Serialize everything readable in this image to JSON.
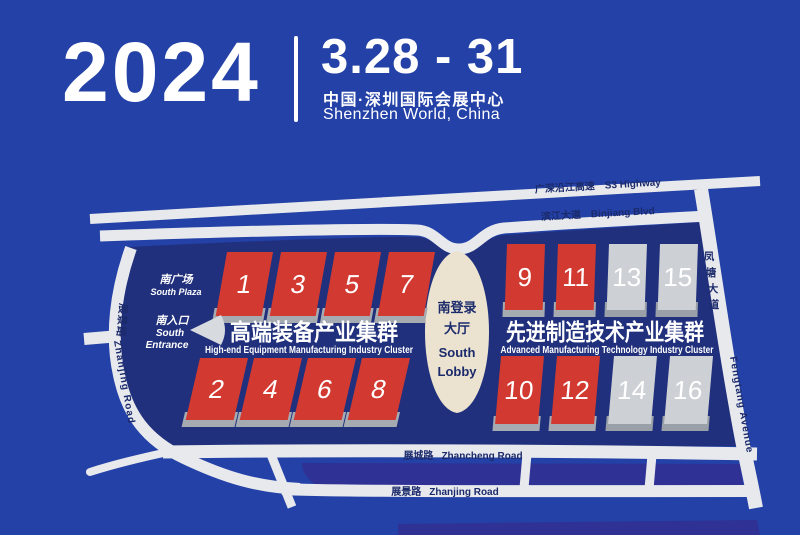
{
  "header": {
    "year": "2024",
    "dates": "3.28 - 31",
    "venue_cn": "中国·深圳国际会展中心",
    "venue_en": "Shenzhen World, China"
  },
  "map": {
    "roads": {
      "s3": {
        "cn": "广深沿江高速",
        "en": "S3 Highway"
      },
      "binjiang": {
        "cn": "滨江大道",
        "en": "Binjiang Blvd"
      },
      "fengtang": {
        "cn_chars": [
          "凤",
          "塘",
          "大",
          "道"
        ],
        "en": "Fengtang Avenue"
      },
      "zhanjing_left": {
        "cn": "展景路",
        "en": "Zhanjing Road"
      },
      "zhancheng": {
        "cn": "展城路",
        "en": "Zhancheng Road"
      },
      "zhanjing_bottom": {
        "cn": "展景路",
        "en": "Zhanjing Road"
      }
    },
    "labels": {
      "south_plaza_cn": "南广场",
      "south_plaza_en": "South Plaza",
      "south_entrance_cn": "南入口",
      "south_entrance_en1": "South",
      "south_entrance_en2": "Entrance",
      "lobby_cn1": "南登录",
      "lobby_cn2": "大厅",
      "lobby_en1": "South",
      "lobby_en2": "Lobby"
    },
    "clusters": {
      "left": {
        "title_cn": "高端装备产业集群",
        "title_en": "High-end Equipment Manufacturing Industry Cluster",
        "hall_color": "#d23a31"
      },
      "right": {
        "title_cn": "先进制造技术产业集群",
        "title_en": "Advanced Manufacturing Technology Industry Cluster",
        "hall_color": "#d23a31"
      }
    },
    "halls": [
      {
        "label": "1",
        "color": "red"
      },
      {
        "label": "3",
        "color": "red"
      },
      {
        "label": "5",
        "color": "red"
      },
      {
        "label": "7",
        "color": "red"
      },
      {
        "label": "2",
        "color": "red"
      },
      {
        "label": "4",
        "color": "red"
      },
      {
        "label": "6",
        "color": "red"
      },
      {
        "label": "8",
        "color": "red"
      },
      {
        "label": "9",
        "color": "red"
      },
      {
        "label": "11",
        "color": "red"
      },
      {
        "label": "13",
        "color": "gray"
      },
      {
        "label": "15",
        "color": "gray"
      },
      {
        "label": "10",
        "color": "red"
      },
      {
        "label": "12",
        "color": "red"
      },
      {
        "label": "14",
        "color": "gray"
      },
      {
        "label": "16",
        "color": "gray"
      }
    ],
    "colors": {
      "background": "#2341a6",
      "map_body": "#20307c",
      "road": "#e8e9ed",
      "median": "#2f3194",
      "hall_red": "#d23a31",
      "hall_gray": "#cdd1d6",
      "lobby": "#ebe3d0",
      "road_text": "#1b2a6b"
    }
  }
}
